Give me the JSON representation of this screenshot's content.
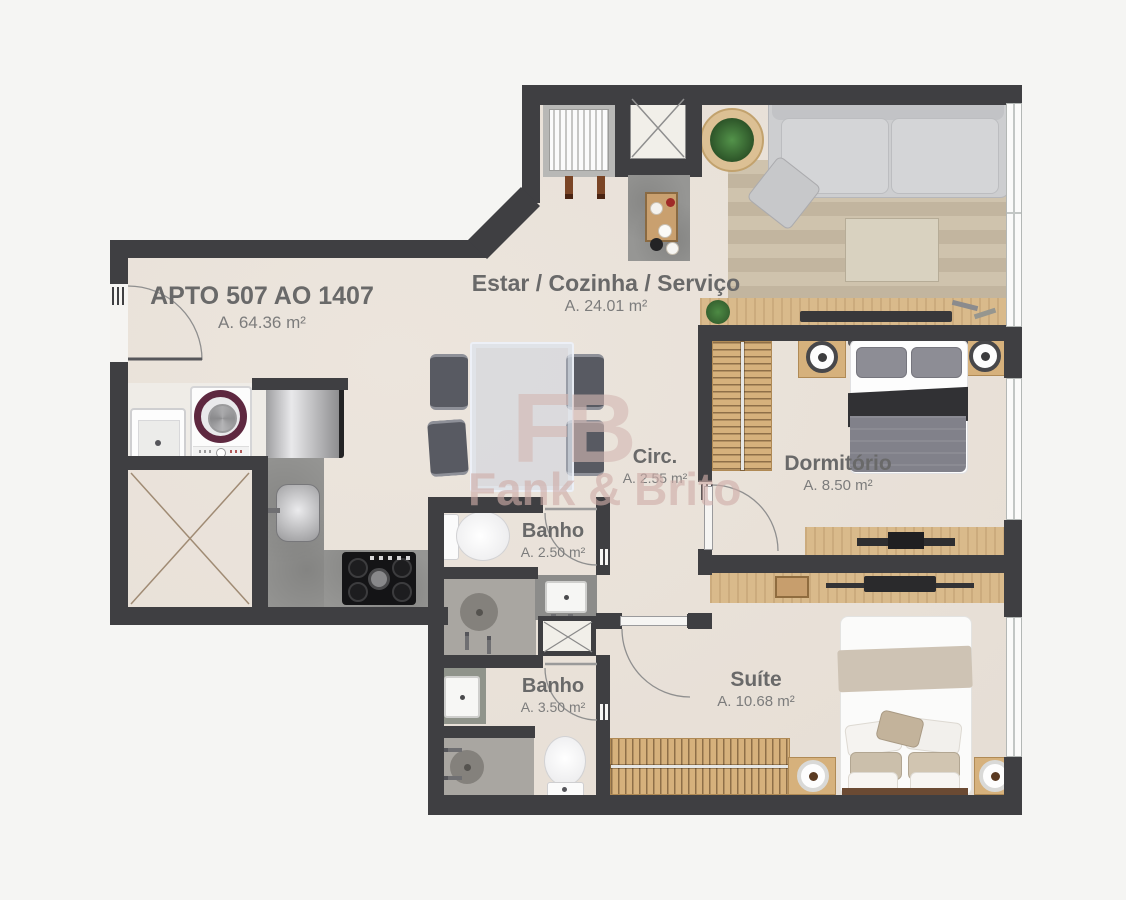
{
  "apartment": {
    "title": "APTO 507 AO 1407",
    "area": "A. 64.36 m²"
  },
  "rooms": {
    "estar": {
      "name": "Estar / Cozinha / Serviço",
      "area": "A. 24.01 m²"
    },
    "circ": {
      "name": "Circ.",
      "area": "A. 2.55 m²"
    },
    "dormitorio": {
      "name": "Dormitório",
      "area": "A. 8.50 m²"
    },
    "banho_social": {
      "name": "Banho",
      "area": "A. 2.50 m²"
    },
    "banho_suite": {
      "name": "Banho",
      "area": "A. 3.50 m²"
    },
    "suite": {
      "name": "Suíte",
      "area": "A. 10.68 m²"
    }
  },
  "watermark": {
    "logo": "FB",
    "name": "Fank & Brito"
  },
  "colors": {
    "wall": "#3f3f42",
    "floor": "#e9e2d9",
    "wood": "#d6b17c",
    "counter": "#969694",
    "rug": "#c9bda7",
    "washer_ring": "#5e2840",
    "shower_floor": "#a9a6a1",
    "watermark": "#d3b8b3"
  }
}
